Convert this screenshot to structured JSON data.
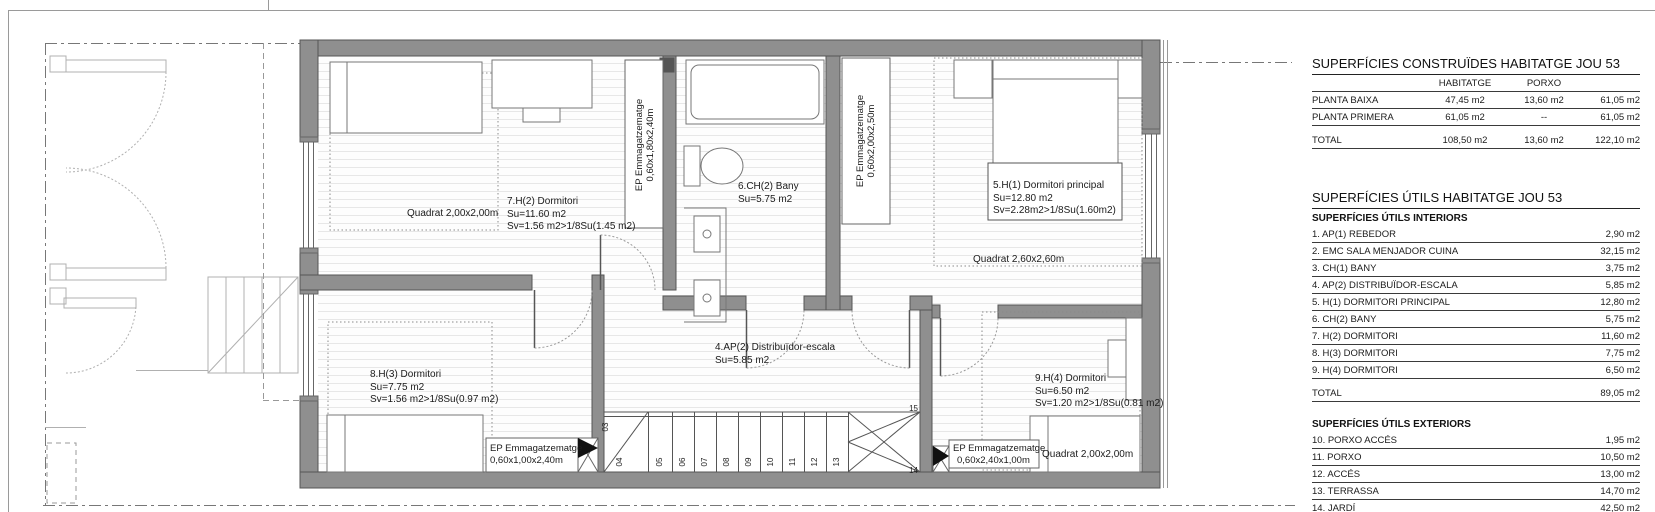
{
  "colors": {
    "wall": "#8f8f8f",
    "line": "#555555",
    "hatch": "#e7e7e7"
  },
  "plan": {
    "rooms": {
      "room7": {
        "name": "7.H(2) Dormitori",
        "su": "Su=11.60 m2",
        "sv": "Sv=1.56 m2>1/8Su(1.45 m2)",
        "quadrat": "Quadrat 2,00x2,00m"
      },
      "room6": {
        "name": "6.CH(2) Bany",
        "su": "Su=5.75 m2"
      },
      "room5": {
        "name": "5.H(1) Dormitori principal",
        "su": "Su=12.80 m2",
        "sv": "Sv=2.28m2>1/8Su(1.60m2)",
        "quadrat": "Quadrat 2,60x2,60m"
      },
      "room4": {
        "name": "4.AP(2) Distribuïdor-escala",
        "su": "Su=5.85 m2"
      },
      "room8": {
        "name": "8.H(3) Dormitori",
        "su": "Su=7.75 m2",
        "sv": "Sv=1.56 m2>1/8Su(0.97 m2)"
      },
      "room9": {
        "name": "9.H(4) Dormitori",
        "su": "Su=6.50 m2",
        "sv": "Sv=1.20 m2>1/8Su(0.81 m2)",
        "quadrat": "Quadrat 2,00x2,00m"
      }
    },
    "storage": {
      "ep1": {
        "l1": "EP Emmagatzematge",
        "l2": "0,60x1,80x2,40m"
      },
      "ep2": {
        "l1": "EP Emmagatzematge",
        "l2": "0,60x2,00x2,50m"
      },
      "ep3": {
        "l1": "EP Emmagatzematge",
        "l2": "0,60x1,00x2,40m"
      },
      "ep4": {
        "l1": "EP Emmagatzematge",
        "l2": "0,60x2,40x1,00m"
      }
    },
    "stair_numbers": [
      "03",
      "04",
      "05",
      "06",
      "07",
      "08",
      "09",
      "10",
      "11",
      "12",
      "13",
      "14",
      "15"
    ]
  },
  "tables": {
    "construides": {
      "title": "SUPERFÍCIES CONSTRUÏDES HABITATGE JOU 53",
      "col_habitatge": "HABITATGE",
      "col_porxo": "PORXO",
      "rows": [
        {
          "label": "PLANTA BAIXA",
          "habitatge": "47,45 m2",
          "porxo": "13,60 m2",
          "total": "61,05 m2"
        },
        {
          "label": "PLANTA PRIMERA",
          "habitatge": "61,05 m2",
          "porxo": "--",
          "total": "61,05 m2"
        }
      ],
      "total_row": {
        "label": "TOTAL",
        "habitatge": "108,50 m2",
        "porxo": "13,60 m2",
        "total": "122,10 m2"
      }
    },
    "utils": {
      "title": "SUPERFÍCIES ÚTILS HABITATGE JOU 53",
      "interiors_header": "SUPERFÍCIES ÚTILS INTERIORS",
      "interiors": [
        {
          "label": "1. AP(1) REBEDOR",
          "value": "2,90 m2"
        },
        {
          "label": "2. EMC SALA MENJADOR CUINA",
          "value": "32,15 m2"
        },
        {
          "label": "3. CH(1) BANY",
          "value": "3,75 m2"
        },
        {
          "label": "4. AP(2) DISTRIBUÏDOR-ESCALA",
          "value": "5,85 m2"
        },
        {
          "label": "5. H(1) DORMITORI PRINCIPAL",
          "value": "12,80 m2"
        },
        {
          "label": "6. CH(2) BANY",
          "value": "5,75 m2"
        },
        {
          "label": "7. H(2) DORMITORI",
          "value": "11,60 m2"
        },
        {
          "label": "8. H(3) DORMITORI",
          "value": "7,75 m2"
        },
        {
          "label": "9. H(4) DORMITORI",
          "value": "6,50 m2"
        }
      ],
      "interiors_total": {
        "label": "TOTAL",
        "value": "89,05 m2"
      },
      "exteriors_header": "SUPERFÍCIES ÚTILS EXTERIORS",
      "exteriors": [
        {
          "label": "10. PORXO ACCÉS",
          "value": "1,95 m2"
        },
        {
          "label": "11. PORXO",
          "value": "10,50 m2"
        },
        {
          "label": "12. ACCÉS",
          "value": "13,00 m2"
        },
        {
          "label": "13. TERRASSA",
          "value": "14,70 m2"
        },
        {
          "label": "14. JARDÍ",
          "value": "42,50 m2"
        }
      ]
    }
  }
}
